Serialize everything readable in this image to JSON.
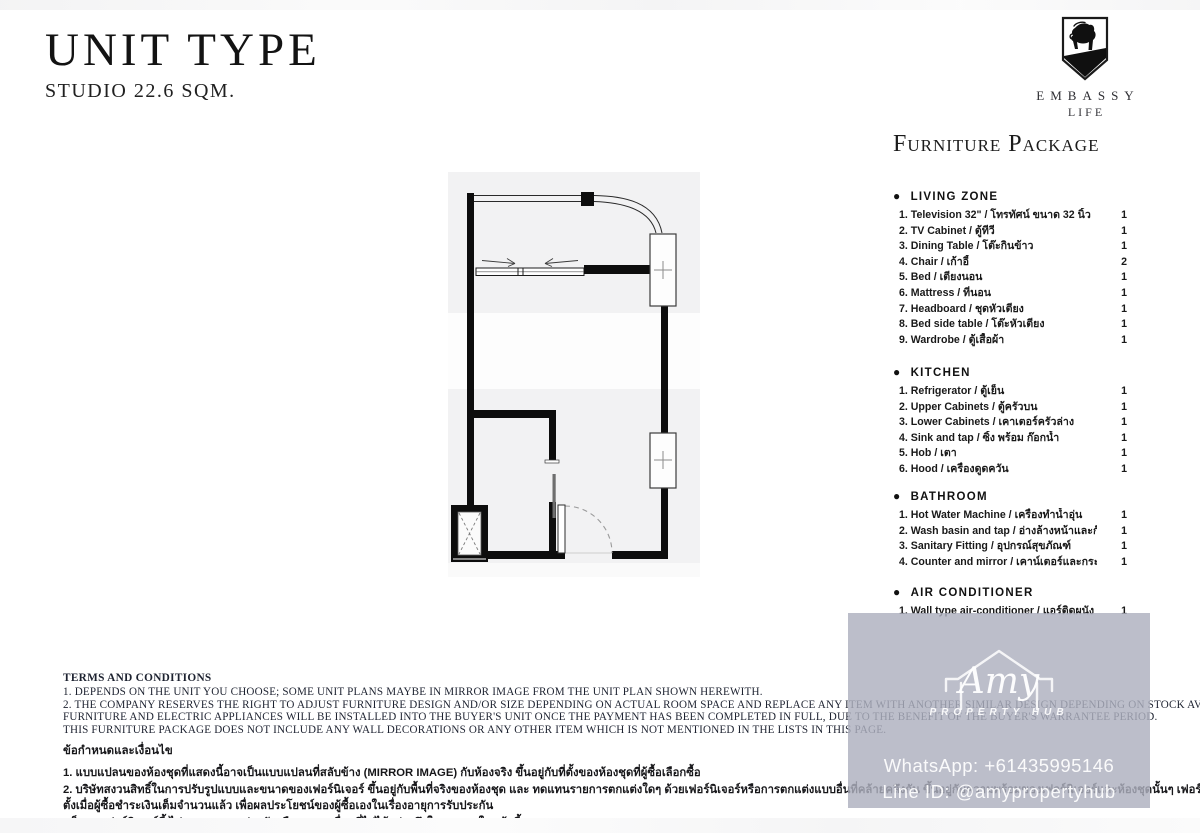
{
  "page": {
    "title": "UNIT TYPE",
    "subtitle": "STUDIO 22.6 SQM."
  },
  "logo": {
    "icon": "lion-shield-icon",
    "brand": "EMBASSY",
    "brand_sub": "LIFE"
  },
  "furniture": {
    "heading": "Furniture Package",
    "bullet": "●",
    "sections": [
      {
        "name": "LIVING ZONE",
        "items": [
          {
            "label": "1.  Television 32\"  / โทรทัศน์ ขนาด 32 นิ้ว",
            "qty": "1"
          },
          {
            "label": "2.  TV Cabinet /  ตู้ทีวี",
            "qty": "1"
          },
          {
            "label": "3.  Dining Table  /  โต๊ะกินข้าว",
            "qty": "1"
          },
          {
            "label": "4.  Chair /  เก้าอี้",
            "qty": "2"
          },
          {
            "label": "5.   Bed / เตียงนอน",
            "qty": "1"
          },
          {
            "label": "6.  Mattress / ที่นอน",
            "qty": "1"
          },
          {
            "label": "7.  Headboard / ชุดหัวเตียง",
            "qty": "1"
          },
          {
            "label": "8.  Bed side table / โต๊ะหัวเตียง",
            "qty": "1"
          },
          {
            "label": "9.  Wardrobe / ตู้เสื้อผ้า",
            "qty": "1"
          }
        ]
      },
      {
        "name": "KITCHEN",
        "items": [
          {
            "label": "1.  Refrigerator / ตู้เย็น",
            "qty": "1"
          },
          {
            "label": "2.  Upper Cabinets / ตู้ครัวบน",
            "qty": "1"
          },
          {
            "label": "3.  Lower Cabinets / เคาเตอร์ครัวล่าง",
            "qty": "1"
          },
          {
            "label": "4.  Sink and tap / ซิ้ง พร้อม ก๊อกน้ำ",
            "qty": "1"
          },
          {
            "label": "5.  Hob   / เตา",
            "qty": "1"
          },
          {
            "label": "6.  Hood / เครื่องดูดควัน",
            "qty": "1"
          }
        ]
      },
      {
        "name": "BATHROOM",
        "items": [
          {
            "label": "1.  Hot Water Machine / เครื่องทำน้ำอุ่น",
            "qty": "1"
          },
          {
            "label": "2.  Wash basin and tap  / อ่างล้างหน้าและก๊อกน้ำ",
            "qty": "1"
          },
          {
            "label": "3.  Sanitary  Fitting / อุปกรณ์สุขภัณฑ์",
            "qty": "1"
          },
          {
            "label": "4.  Counter and mirror / เคาน์เตอร์และกระจก",
            "qty": "1"
          }
        ]
      },
      {
        "name": "AIR CONDITIONER",
        "items": [
          {
            "label": "1.  Wall type air-conditioner /  แอร์ติดผนัง",
            "qty": "1"
          }
        ]
      }
    ]
  },
  "terms_en": {
    "heading": "TERMS AND CONDITIONS",
    "lines": [
      "1. DEPENDS ON THE UNIT YOU CHOOSE; SOME UNIT PLANS MAYBE IN MIRROR IMAGE FROM THE UNIT PLAN SHOWN HEREWITH.",
      "2. THE COMPANY RESERVES THE RIGHT TO ADJUST FURNITURE DESIGN AND/OR SIZE DEPENDING ON ACTUAL ROOM SPACE AND REPLACE ANY ITEM WITH ANOTHER SIMILAR DESIGN DEPENDING ON STOCK AVAILABILITY. ALL LOOSE",
      "FURNITURE AND ELECTRIC APPLIANCES WILL BE INSTALLED INTO THE BUYER'S UNIT ONCE THE PAYMENT HAS BEEN COMPLETED IN FULL, DUE TO THE BENEFIT OF THE BUYER'S WARRANTEE PERIOD.",
      "THIS FURNITURE PACKAGE DOES NOT INCLUDE ANY WALL DECORATIONS OR ANY OTHER ITEM WHICH IS NOT MENTIONED IN THE LISTS IN THIS PAGE."
    ]
  },
  "terms_th": {
    "heading": "ข้อกำหนดและเงื่อนไข",
    "lines": [
      "1.  แบบแปลนของห้องชุดที่แสดงนี้อาจเป็นแบบแปลนที่สลับข้าง (MIRROR IMAGE) กับห้องจริง ขึ้นอยู่กับที่ตั้งของห้องชุดที่ผู้ซื้อเลือกซื้อ",
      "2.  บริษัทสงวนสิทธิ์ในการปรับรูปแบบและขนาดของเฟอร์นิเจอร์ ขึ้นอยู่กับพื้นที่จริงของห้องชุด และ ทดแทนรายการตกแต่งใดๆ ด้วยเฟอร์นิเจอร์หรือการตกแต่งแบบอื่นที่คล้ายคลึงกัน ขึ้นอยู่กับความพร้อมของเฟอร์นิเจอร์และห้องชุดนั้นๆ เฟอร์นิเจอร์ลอยตัวและเครื่องใช้ไฟฟ้าทั้งหมดจะถูกติด",
      "ตั้งเมื่อผู้ซื้อชำระเงินเต็มจำนวนแล้ว เพื่อผลประโยชน์ของผู้ซื้อเองในเรื่องอายุการรับประกัน",
      "แพ็คเกจเฟอร์นิเจอร์นี้ ไม่รวมการตกแต่งผนังหรือรายการอื่นๆที่ไม่ได้กล่าวถึงในรายการในหน้านี้"
    ]
  },
  "watermark": {
    "icon": "house-outline-icon",
    "brand_script": "Amy",
    "brand_tag": "PROPERTY HUB",
    "whatsapp": "WhatsApp: +61435995146",
    "line_id": "Line ID: @amypropertyhub",
    "bg_color": "#adb0be"
  }
}
